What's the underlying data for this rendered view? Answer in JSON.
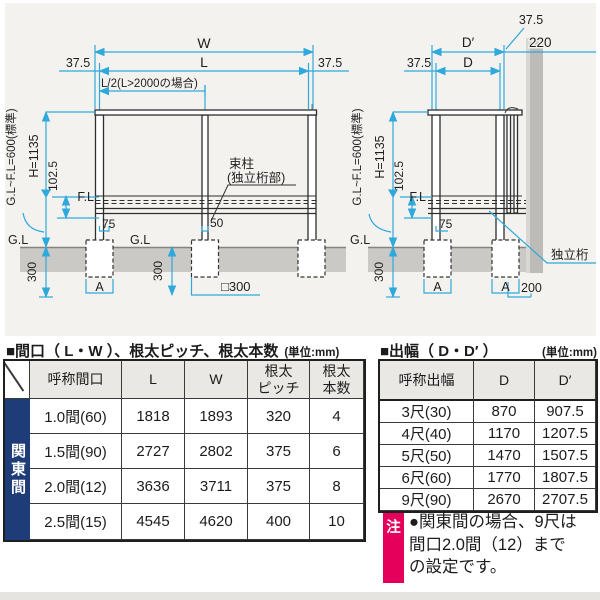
{
  "left_diagram": {
    "dim_w": "W",
    "dim_l": "L",
    "offset_left": "37.5",
    "offset_right": "37.5",
    "half_span": "L/2(L>2000の場合)",
    "height_total": "H=1135",
    "gl_fl": "G.L~F.L=600(標準)",
    "dim_102": "102.5",
    "fl": "F.L",
    "gl_left": "G.L",
    "gl_mid": "G.L",
    "dim_75": "75",
    "dim_50": "50",
    "post_label_line1": "束柱",
    "post_label_line2": "(独立桁部)",
    "depth_left": "300",
    "depth_mid": "300",
    "footing_a": "A",
    "footing_size": "□300"
  },
  "right_diagram": {
    "dim_dprime": "D′",
    "dim_d": "D",
    "offset_left": "37.5",
    "offset_top": "37.5",
    "wall_dim": "220",
    "height_total": "H=1135",
    "gl_fl": "G.L~F.L=600(標準)",
    "dim_102": "102.5",
    "fl": "F.L",
    "gl": "G.L",
    "dim_75": "75",
    "depth": "300",
    "footing_a1": "A",
    "footing_a2": "A",
    "dim_200": "200",
    "beam_label": "独立桁"
  },
  "left_table": {
    "title": "■間口（ L・W ）、根太ピッチ、根太本数",
    "unit": "(単位:mm)",
    "group": "関東間",
    "headers": {
      "name": "呼称間口",
      "l": "L",
      "w": "W",
      "pitch": "根太\nピッチ",
      "count": "根太\n本数"
    },
    "rows": [
      {
        "name": "1.0間(60)",
        "l": "1818",
        "w": "1893",
        "pitch": "320",
        "count": "4"
      },
      {
        "name": "1.5間(90)",
        "l": "2727",
        "w": "2802",
        "pitch": "375",
        "count": "6"
      },
      {
        "name": "2.0間(12)",
        "l": "3636",
        "w": "3711",
        "pitch": "375",
        "count": "8"
      },
      {
        "name": "2.5間(15)",
        "l": "4545",
        "w": "4620",
        "pitch": "400",
        "count": "10"
      }
    ]
  },
  "right_table": {
    "title": "■出幅（ D・D′ ）",
    "unit": "(単位:mm)",
    "headers": {
      "name": "呼称出幅",
      "d": "D",
      "dprime": "D′"
    },
    "rows": [
      {
        "name": "3尺(30)",
        "d": "870",
        "dprime": "907.5"
      },
      {
        "name": "4尺(40)",
        "d": "1170",
        "dprime": "1207.5"
      },
      {
        "name": "5尺(50)",
        "d": "1470",
        "dprime": "1507.5"
      },
      {
        "name": "6尺(60)",
        "d": "1770",
        "dprime": "1807.5"
      },
      {
        "name": "9尺(90)",
        "d": "2670",
        "dprime": "2707.5"
      }
    ]
  },
  "note": {
    "badge": "注",
    "line1": "●関東間の場合、9尺は",
    "line2": "間口2.0間（12）まで",
    "line3": "の設定です。"
  },
  "colors": {
    "dimension_blue": "#2fa8dc",
    "group_navy": "#1e3c78",
    "note_pink": "#e5005c",
    "diagram_bg": "#f3f2ef"
  }
}
